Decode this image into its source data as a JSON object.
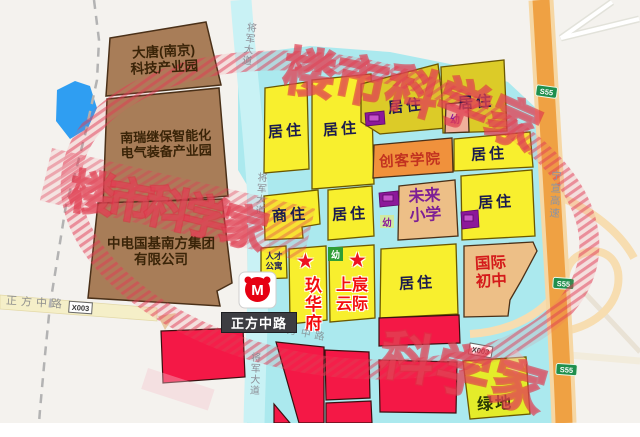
{
  "map": {
    "region_labels": {
      "residential": "居住",
      "commercial_residential": "商住",
      "green_space": "绿地",
      "kindergarten": "幼"
    },
    "companies": {
      "cigu": {
        "line1": "南京磁谷",
        "line2": "科技股份有限公司"
      },
      "datang": {
        "line1": "大唐(南京)",
        "line2": "科技产业园"
      },
      "nari": {
        "line1": "南瑞继保智能化",
        "line2": "电气装备产业园"
      },
      "cetc": {
        "line1": "中电国基南方集团",
        "line2": "有限公司"
      }
    },
    "facilities": {
      "maker_college": "创客学院",
      "future_primary": {
        "line1": "未来",
        "line2": "小学"
      },
      "intl_middle": {
        "line1": "国际",
        "line2": "初中"
      },
      "talent_apartment": {
        "line1": "人才",
        "line2": "公寓"
      }
    },
    "projects": {
      "jiuhuafu": "玖华府",
      "shangchen": {
        "line1": "上宸",
        "line2": "云际"
      }
    },
    "roads": {
      "jiangjun_avenue": "将军大道",
      "zhengfang_middle_road": "正方中路",
      "zhengfang_partial": "方中路",
      "ningxuan_expressway": "宁宣高速",
      "county_road_badge": "X003",
      "expressway_shield": "S55"
    },
    "metro_letter": "M",
    "watermark_chars": [
      "楼",
      "市",
      "科",
      "学",
      "家"
    ],
    "watermark_text": "楼市科学家",
    "colors": {
      "cyan_area": "#abe9ee",
      "yellow_parcel": "#f8ef2e",
      "gold_parcel": "#dccb28",
      "brown_parcel": "#a87d58",
      "tan_parcel": "#edbf87",
      "orange_parcel": "#f0913c",
      "red_parcel": "#f41846",
      "green_parcel": "#e4ec2a",
      "highway_orange": "#efa143",
      "lake_blue": "#2f9ef2",
      "shield_green": "#1f8f4d",
      "watermark_red": "#e23d55",
      "metro_red": "#e60012"
    }
  }
}
